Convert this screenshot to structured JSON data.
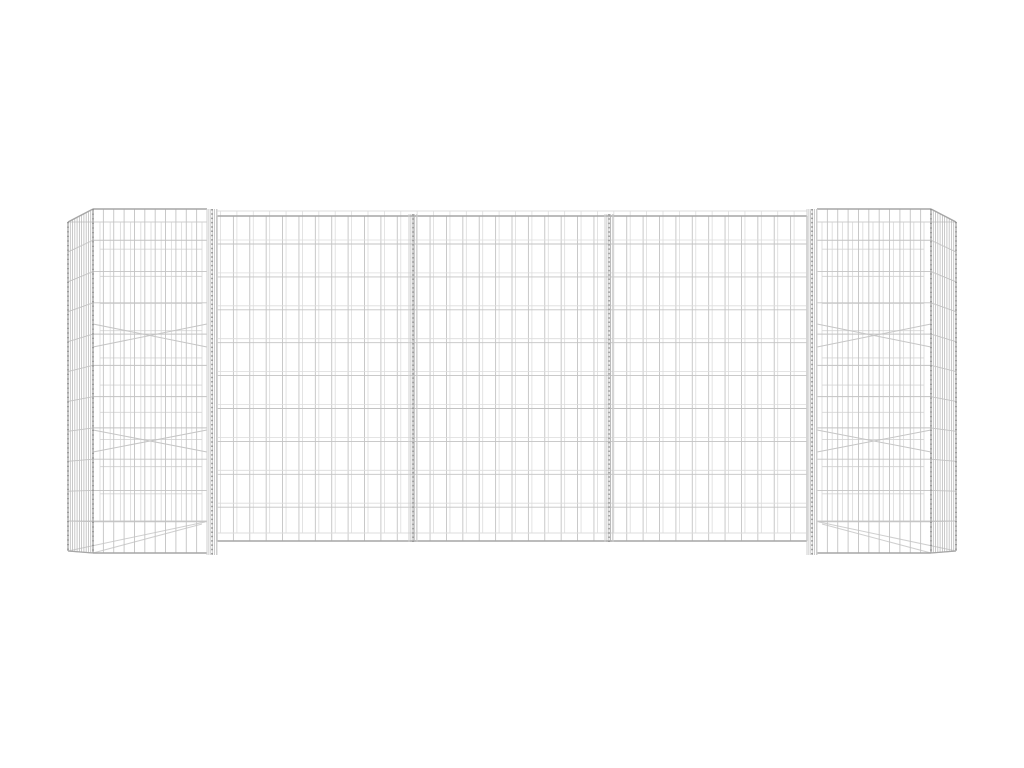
{
  "scene": {
    "type": "product-photo",
    "subject": "h-shaped-gabion-wire-mesh-planter",
    "background_color": "#ffffff",
    "colors": {
      "wire": "#c3c3c3",
      "wire_faint": "#dcdcdc",
      "wire_mid": "#cfcfcf",
      "wire_strong": "#a6a6a6",
      "hatch": "#b7b7b7",
      "knot": "#8f8f8f",
      "brace": "#c6c6c6"
    }
  },
  "geometry": {
    "canvas": {
      "w": 1024,
      "h": 768
    },
    "wall": {
      "name": "gabion-wall-panel",
      "x1": 217,
      "x2": 807,
      "top_faint": 211,
      "top": 216,
      "bottom_faint": 533,
      "bottom": 541,
      "v_spacing": 16.4,
      "v_twin_offset": 3.5,
      "h_rows": 9,
      "h_start": 244,
      "h_spacing": 32.9,
      "h_twin_offset": -4,
      "dividers": [
        [
          409,
          417
        ],
        [
          605,
          613
        ]
      ]
    },
    "columns": [
      {
        "name": "left-gabion-column",
        "side": "left",
        "side_x": 68,
        "front_x1": 93,
        "front_x2": 207,
        "joint": [
          207,
          217
        ],
        "top": 209,
        "bottom": 553,
        "back_top": 222,
        "back_bottom": 521,
        "back_x1": 100,
        "back_x2": 202,
        "front_cols": 11,
        "front_rows": 11,
        "side_top_offset": 13,
        "side_bottom_offset": -2,
        "braces": [
          [
            324,
            347
          ],
          [
            430,
            452
          ]
        ]
      },
      {
        "name": "right-gabion-column",
        "side": "right",
        "side_x": 956,
        "front_x1": 817,
        "front_x2": 931,
        "joint": [
          807,
          817
        ],
        "top": 209,
        "bottom": 553,
        "back_top": 222,
        "back_bottom": 521,
        "back_x1": 822,
        "back_x2": 924,
        "front_cols": 11,
        "front_rows": 11,
        "side_top_offset": 13,
        "side_bottom_offset": -2,
        "braces": [
          [
            324,
            347
          ],
          [
            430,
            452
          ]
        ]
      }
    ]
  }
}
